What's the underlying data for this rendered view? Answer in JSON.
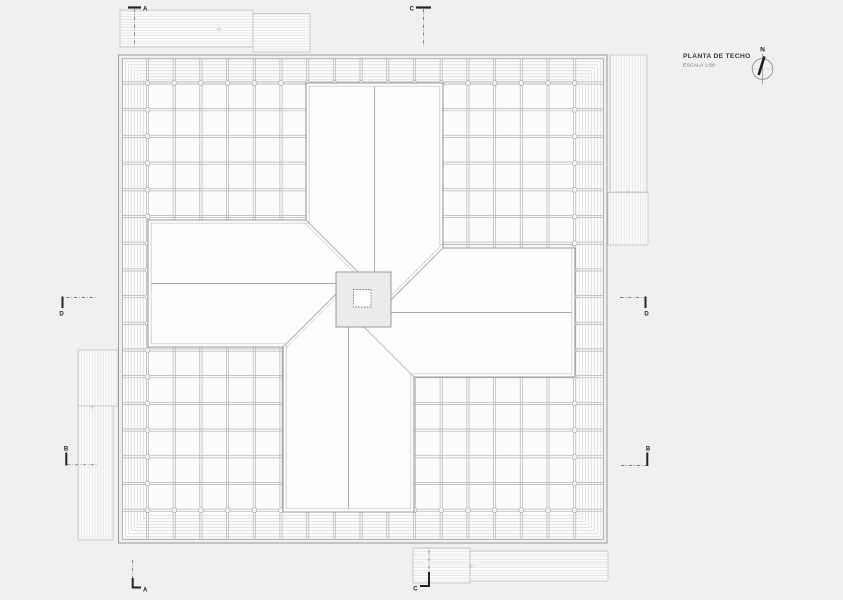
{
  "drawing": {
    "title": "PLANTA DE TECHO",
    "scale": "ESCALA 1:50",
    "north_label": "N",
    "sections": {
      "a_top": "A",
      "c_top": "C",
      "a_bottom": "A",
      "c_bottom": "C",
      "d_left": "D",
      "d_right": "D",
      "b_left": "B",
      "b_right": "B"
    }
  },
  "colors": {
    "page_background": "#f0f0f0",
    "paper": "#fcfcfc",
    "wing_fill": "#fdfdfd",
    "center_fill": "#ebebeb",
    "outline": "#9a9a9a",
    "grid_line": "#b3b3b3",
    "detail_line": "#a8a8a8",
    "frame_line": "#d9d9d9",
    "hatch_line": "#dcdcdc",
    "marker_dark": "#222222"
  }
}
